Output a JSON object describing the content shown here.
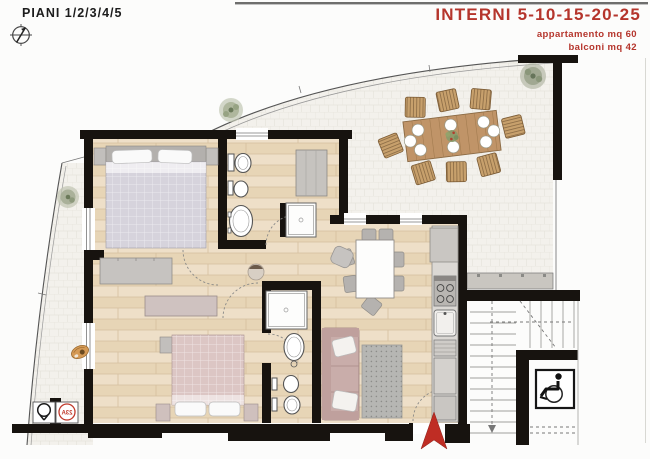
{
  "header": {
    "floors": "PIANI 1/2/3/4/5",
    "title": "INTERNI 5-10-15-20-25",
    "apartment_area": "appartamento mq 60",
    "balcony_area": "balconi mq 42"
  },
  "plan": {
    "unit_badge": "23A",
    "colors": {
      "accent_red": "#b5352c",
      "wall_black": "#17130f",
      "wood_floor": "#ebdabf",
      "terrace_tile": "#f3f1ec",
      "furniture_gray": "#c2bfbc",
      "bed1_blanket": "#d6d3dc",
      "bed2_blanket": "#dcc6c4",
      "sofa_mauve": "#c9adaa",
      "entry_arrow_red": "#bf2d24"
    },
    "icons": [
      "compass-icon",
      "wheelchair-accessible-icon",
      "plant-icon",
      "unit-number-badge",
      "tree-symbol-badge",
      "entry-arrow"
    ]
  }
}
